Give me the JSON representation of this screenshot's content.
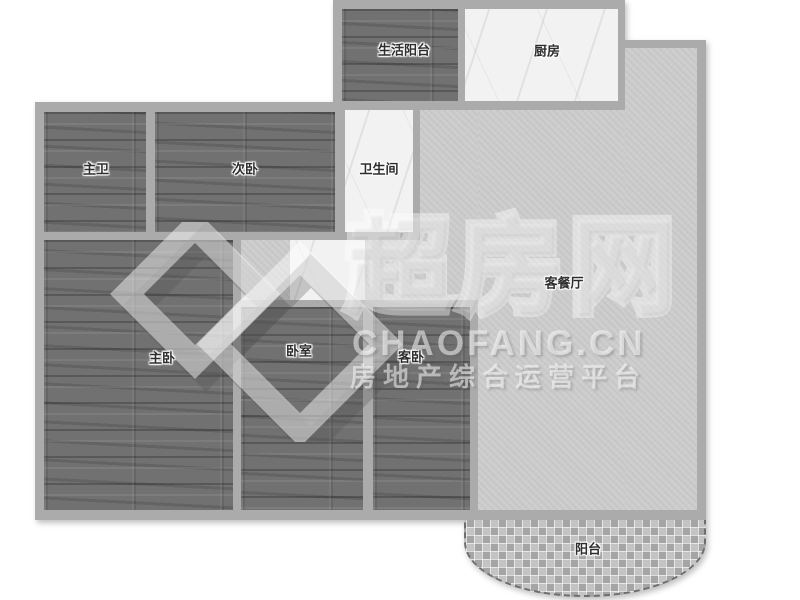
{
  "plan": {
    "title": "apartment-floor-plan",
    "rooms": [
      {
        "key": "life_balcony",
        "label": "生活阳台",
        "floor": "wood"
      },
      {
        "key": "kitchen",
        "label": "厨房",
        "floor": "marble"
      },
      {
        "key": "master_bath",
        "label": "主卫",
        "floor": "wood"
      },
      {
        "key": "second_bedroom",
        "label": "次卧",
        "floor": "wood"
      },
      {
        "key": "bathroom",
        "label": "卫生间",
        "floor": "marble"
      },
      {
        "key": "living_dining",
        "label": "客餐厅",
        "floor": "stone"
      },
      {
        "key": "master_bedroom",
        "label": "主卧",
        "floor": "wood"
      },
      {
        "key": "bedroom",
        "label": "卧室",
        "floor": "wood"
      },
      {
        "key": "guest_bedroom",
        "label": "客卧",
        "floor": "wood"
      },
      {
        "key": "balcony",
        "label": "阳台",
        "floor": "mosaic"
      }
    ]
  },
  "watermark": {
    "brand": "超房网",
    "domain": "CHAOFANG.CN",
    "tagline": "房地产综合运营平台"
  },
  "colors": {
    "wall": "#ababab",
    "wood_floor": "#717171",
    "marble_floor": "#f2f2f2",
    "living_floor": "#cdcdcd",
    "mosaic_floor": "#b2b2b2",
    "background": "#ffffff",
    "label_text": "#2e2e2e"
  }
}
